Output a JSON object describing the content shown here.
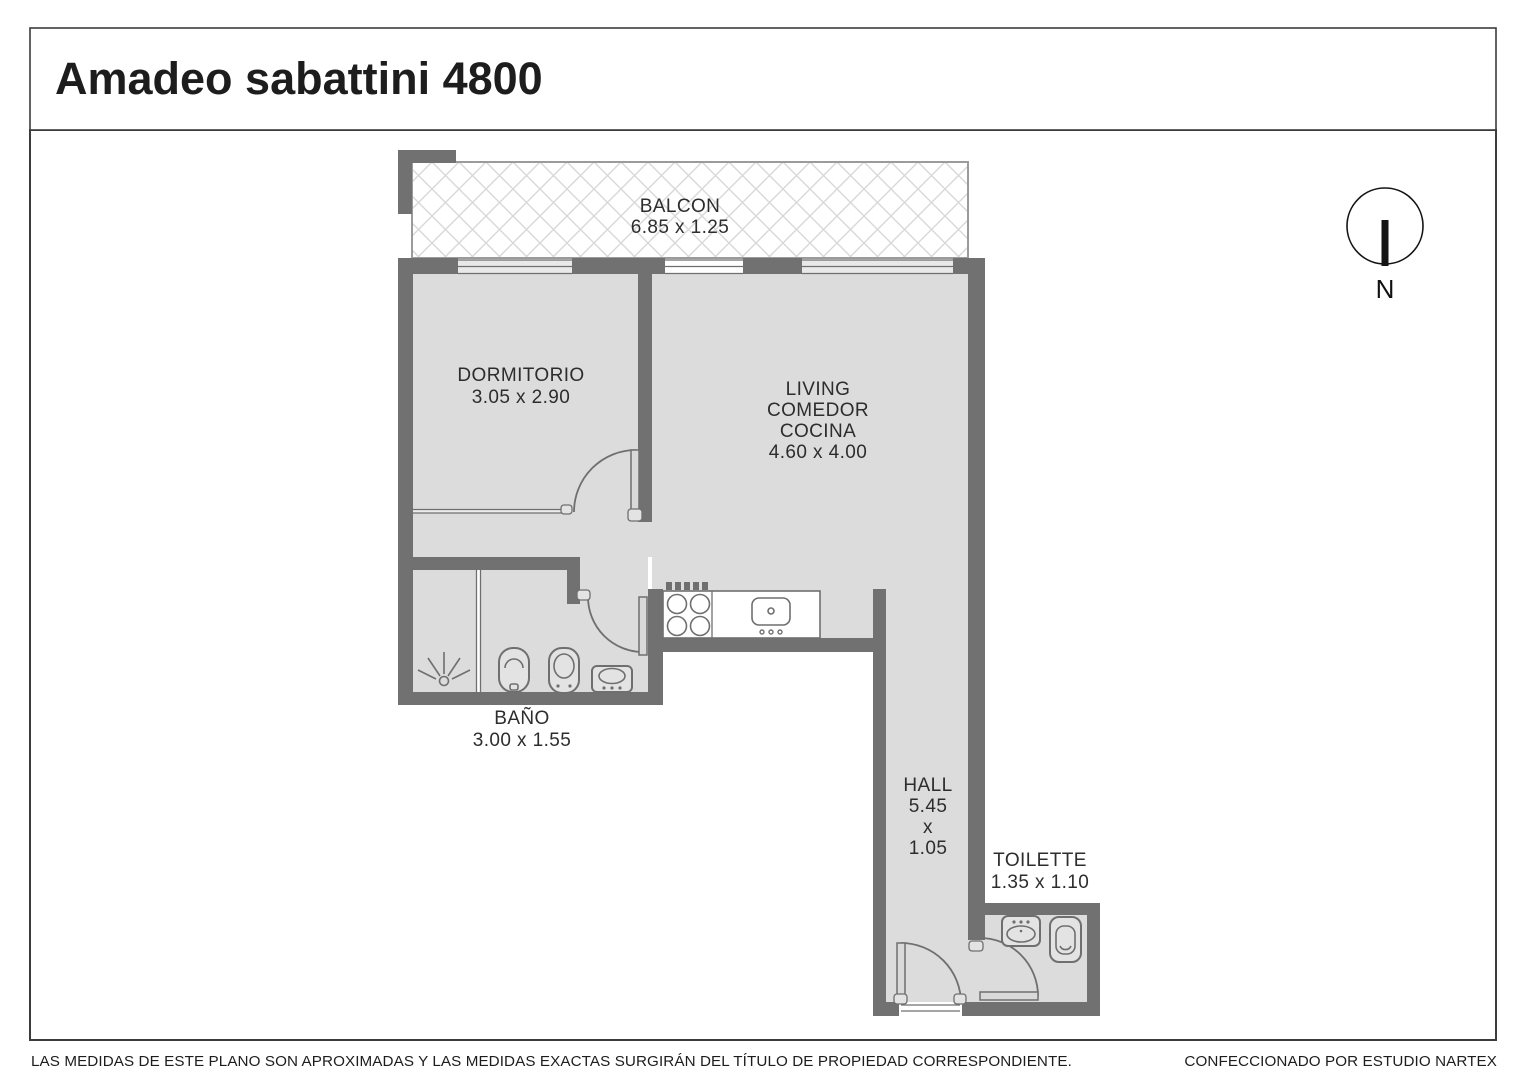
{
  "header": {
    "title": "Amadeo sabattini 4800"
  },
  "plan": {
    "rooms": [
      {
        "id": "balcon",
        "lines": [
          "BALCON",
          "6.85 x 1.25"
        ]
      },
      {
        "id": "dormitorio",
        "lines": [
          "DORMITORIO",
          "3.05 x 2.90"
        ]
      },
      {
        "id": "living",
        "lines": [
          "LIVING",
          "COMEDOR",
          "COCINA",
          "4.60 x 4.00"
        ]
      },
      {
        "id": "bano",
        "lines": [
          "BAÑO",
          "3.00 x 1.55"
        ]
      },
      {
        "id": "hall",
        "lines": [
          "HALL",
          "5.45",
          "x",
          "1.05"
        ]
      },
      {
        "id": "toilette",
        "lines": [
          "TOILETTE",
          "1.35 x 1.10"
        ]
      }
    ],
    "north_label": "N"
  },
  "footer": {
    "left": "LAS MEDIDAS  DE ESTE PLANO SON APROXIMADAS Y LAS MEDIDAS EXACTAS SURGIRÁN DEL TÍTULO DE PROPIEDAD CORRESPONDIENTE.",
    "right": "CONFECCIONADO POR ESTUDIO NARTEX"
  },
  "colors": {
    "wall": "#717171",
    "floor": "#dcdcdc",
    "hatch_line": "#d8d8d8",
    "fixture_outline": "#6f6f6f",
    "label_text": "#2d2d2d",
    "border": "#3c3c3c"
  }
}
